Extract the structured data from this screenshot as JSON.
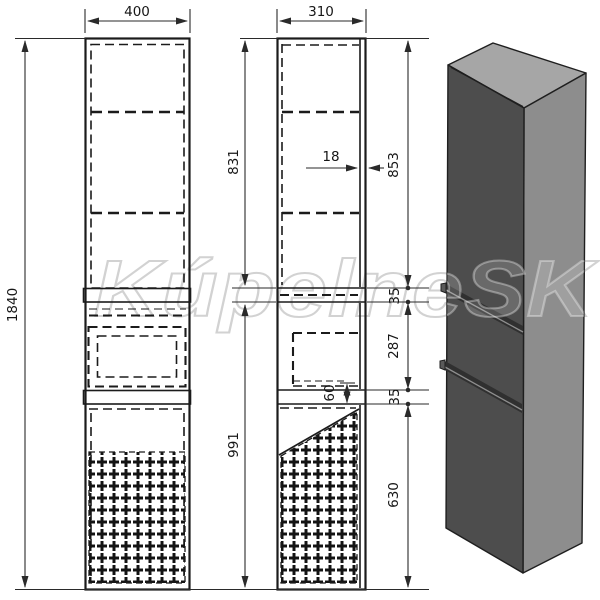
{
  "drawing": {
    "watermark": "KúpelneSK",
    "dimensions": {
      "front_width": "400",
      "side_depth": "310",
      "total_height": "1840",
      "upper_section_height": "831",
      "lower_section_height": "991",
      "door_thickness": "18",
      "upper_door_height": "853",
      "upper_gap": "35",
      "drawer_section_height": "287",
      "lower_gap": "35",
      "lower_door_height": "630",
      "drawer_bottom_offset": "60"
    },
    "colors": {
      "line": "#1b1b1b",
      "iso_top": "#a6a6a6",
      "iso_side": "#8d8d8d",
      "iso_front": "#4d4d4d",
      "groove": "#303030"
    }
  }
}
